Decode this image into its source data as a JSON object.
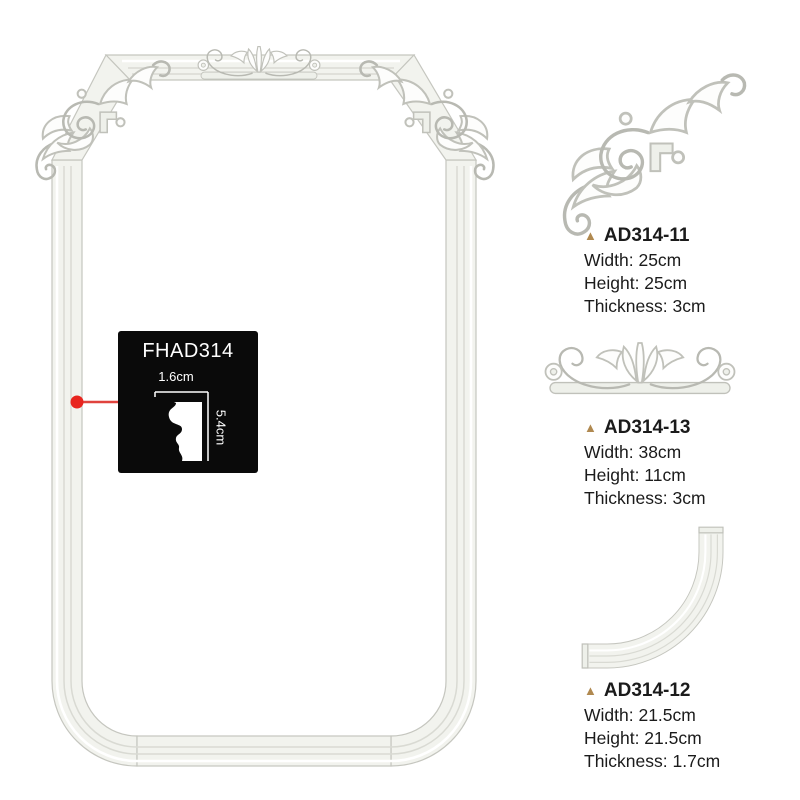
{
  "callout": {
    "code": "FHAD314",
    "width_label": "1.6cm",
    "height_label": "5.4cm"
  },
  "icons": {
    "bullet": "▲"
  },
  "products": [
    {
      "code": "AD314-11",
      "width": "Width: 25cm",
      "height": "Height: 25cm",
      "thickness": "Thickness: 3cm"
    },
    {
      "code": "AD314-13",
      "width": "Width: 38cm",
      "height": "Height: 11cm",
      "thickness": "Thickness: 3cm"
    },
    {
      "code": "AD314-12",
      "width": "Width: 21.5cm",
      "height": "Height: 21.5cm",
      "thickness": "Thickness: 1.7cm"
    }
  ],
  "colors": {
    "background": "#ffffff",
    "callout_background": "#0a0a0a",
    "callout_text": "#ffffff",
    "accent_red": "#e8251f",
    "bullet_gold": "#b08950",
    "text": "#1b1b1b",
    "moulding_fill": "#f2f3ee",
    "moulding_edge": "#c5c6bf"
  }
}
